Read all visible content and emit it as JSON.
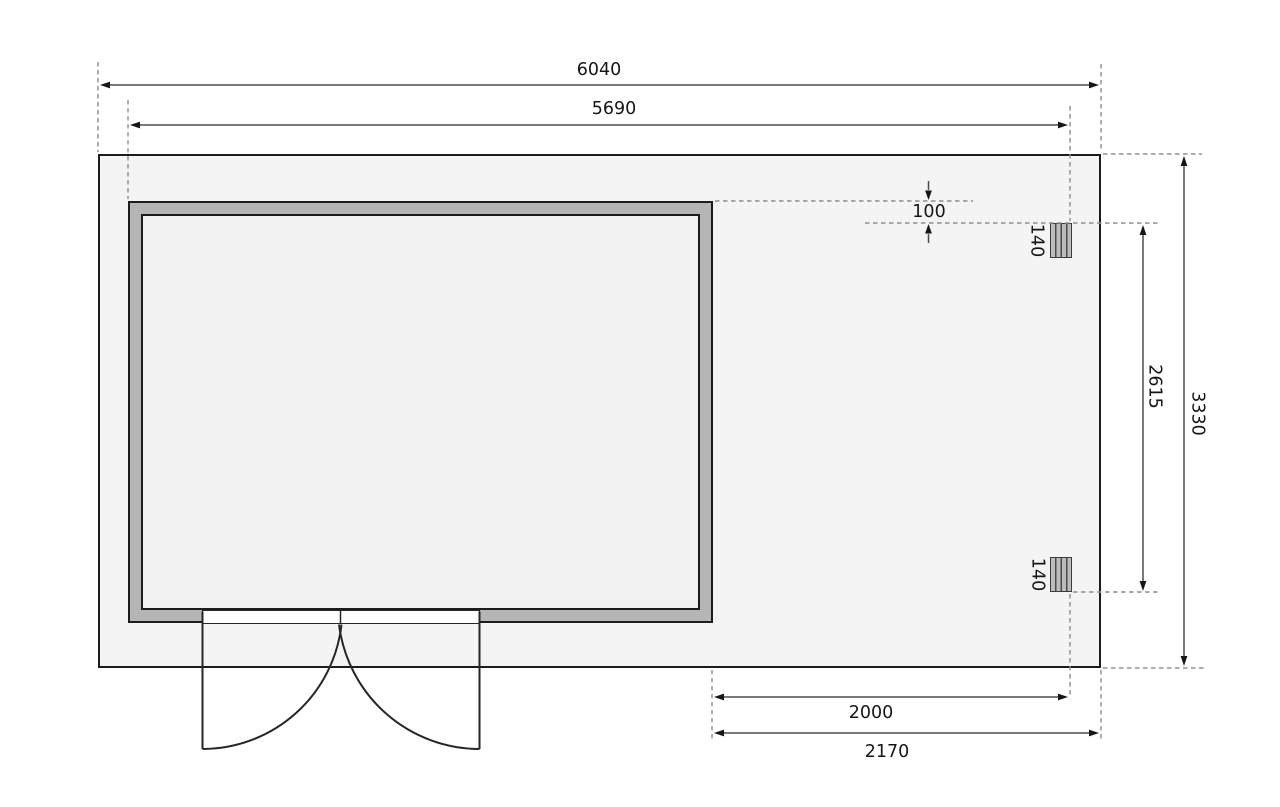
{
  "dimensions": {
    "total_width": "6040",
    "cabin_outer_width": "5690",
    "total_depth": "3330",
    "post_span": "2615",
    "terrace_clear_width": "2000",
    "terrace_total_width": "2170",
    "post_top_offset": "100",
    "post_section_top": "140",
    "post_section_bottom": "140"
  },
  "colors": {
    "outline": "#1c1c1c",
    "dimension_line": "#4d4d4d",
    "reference_dashed": "#8f8f8f",
    "slab_fill": "#f4f4f4",
    "interior_fill": "#f1f1f1",
    "wall_fill": "#b5b5b5",
    "post_fill": "#bdbdbd",
    "background": "#ffffff"
  }
}
